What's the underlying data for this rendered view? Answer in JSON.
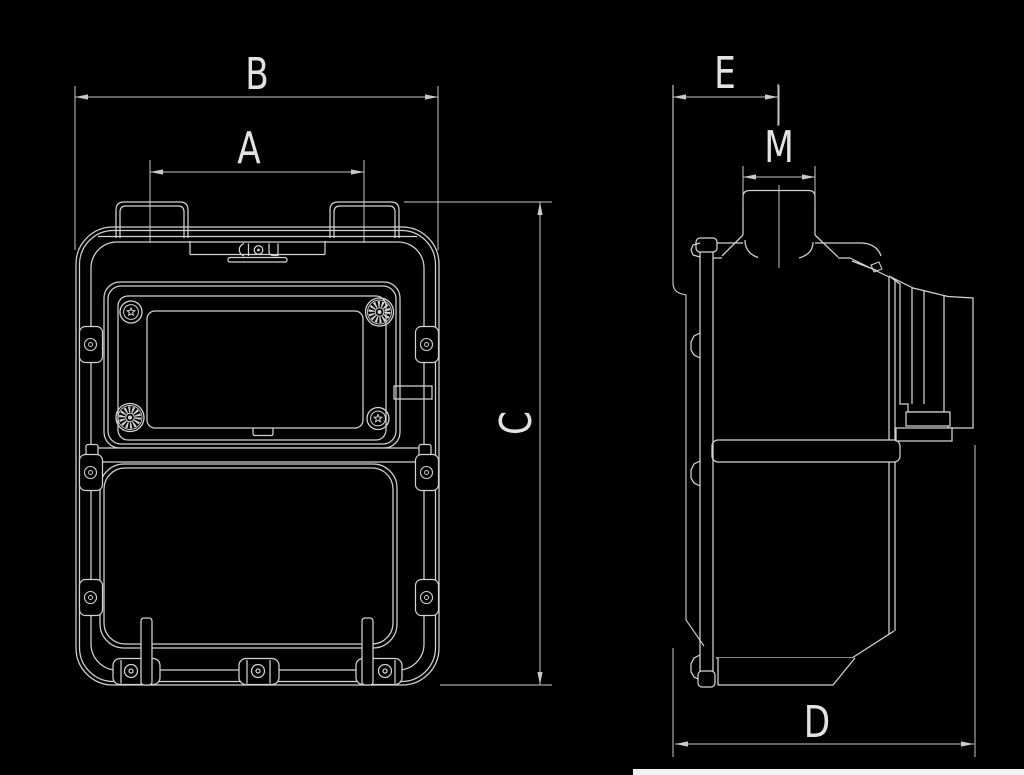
{
  "figure": {
    "type": "technical-drawing",
    "description_keys_only": "gas-meter two-view dimension drawing",
    "background_color": "#000000",
    "line_color": "#d4d4d4",
    "dim_line_color": "#c9c9c9",
    "label_color": "#e3e3e3",
    "bottom_strip_color": "#f2f2f2",
    "labels": {
      "front_inner_width": "A",
      "front_overall_width": "B",
      "front_overall_height": "C",
      "side_overall_depth": "D",
      "side_face_to_pipe_axis": "E",
      "pipe_connection_width": "M"
    }
  }
}
